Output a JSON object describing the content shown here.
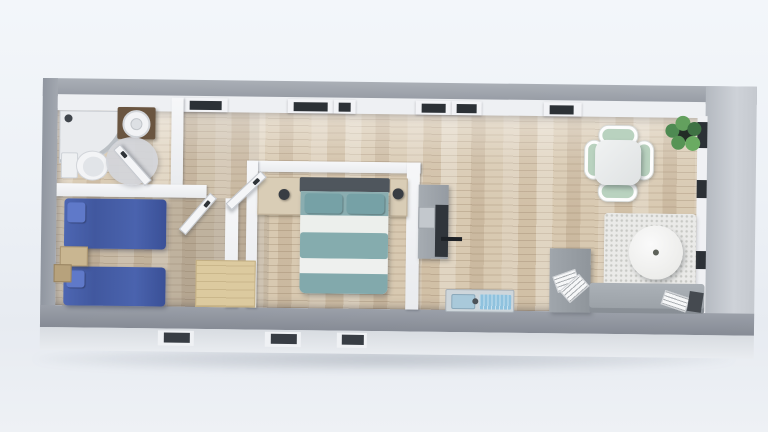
{
  "scene": {
    "title": "Top-down 3D floor plan render of a long narrow tiny home",
    "view": "dollhouse overhead view, no visible text labels"
  },
  "palette": {
    "background": "#edf1f6",
    "exterior_wall": "#9aa0a8",
    "exterior_wall_light": "#ced2d8",
    "facade": "#d8dce1",
    "interior_wall": "#f3f4f6",
    "floor_wood": "#d8c9b1",
    "window_frame_dark": "#2c3136",
    "bed_blue": "#4a63ae",
    "pillow_blue": "#5f79c9",
    "bed_teal": "#85acae",
    "sheet_white": "#ecefec",
    "headboard_gray": "#4f565d",
    "nightstand_wood": "#d9cdb6",
    "step_wood_tan": "#dcca9f",
    "vanity_wood": "#6a5540",
    "counter_gray": "#9ba1a8",
    "cooktop_black": "#30353b",
    "sink_steel": "#ced6db",
    "sink_blue": "#8fc2de",
    "chair_mint": "#b9d2bf",
    "table_white": "#e8eaeb",
    "rug_white": "#eaeae8",
    "sofa_gray": "#a3a9af",
    "desk_gray": "#999fa5",
    "plant_green": "#55904f"
  },
  "rooms": [
    {
      "id": "bathroom",
      "label": "Bathroom",
      "furniture": [
        "corner shower",
        "round basin on dark wood vanity",
        "toilet",
        "round bath mat",
        "door"
      ]
    },
    {
      "id": "small-bedroom",
      "label": "Small bedroom",
      "furniture": [
        "blue twin bed",
        "blue twin bed",
        "wooden nightstand",
        "wooden side table",
        "door"
      ]
    },
    {
      "id": "hallway",
      "label": "Hallway",
      "furniture": [
        "wooden steps",
        "open doors"
      ]
    },
    {
      "id": "master-bedroom",
      "label": "Master bedroom",
      "furniture": [
        "double bed with teal and white striped bedding",
        "dark headboard",
        "left nightstand with lamp",
        "right nightstand with lamp",
        "door"
      ]
    },
    {
      "id": "kitchen",
      "label": "Kitchenette",
      "furniture": [
        "gray counter",
        "black cooktop strip",
        "oven with handle",
        "stainless sink with blue basins"
      ]
    },
    {
      "id": "living-dining",
      "label": "Living and dining area",
      "furniture": [
        "square white dining table",
        "four mint green chairs",
        "potted plant",
        "white shag rug",
        "round white table",
        "gray desk with papers",
        "gray sofa",
        "magazine"
      ]
    }
  ],
  "windows": {
    "top_wall_count": 6,
    "right_wall_count": 3,
    "front_facade_count": 3
  }
}
